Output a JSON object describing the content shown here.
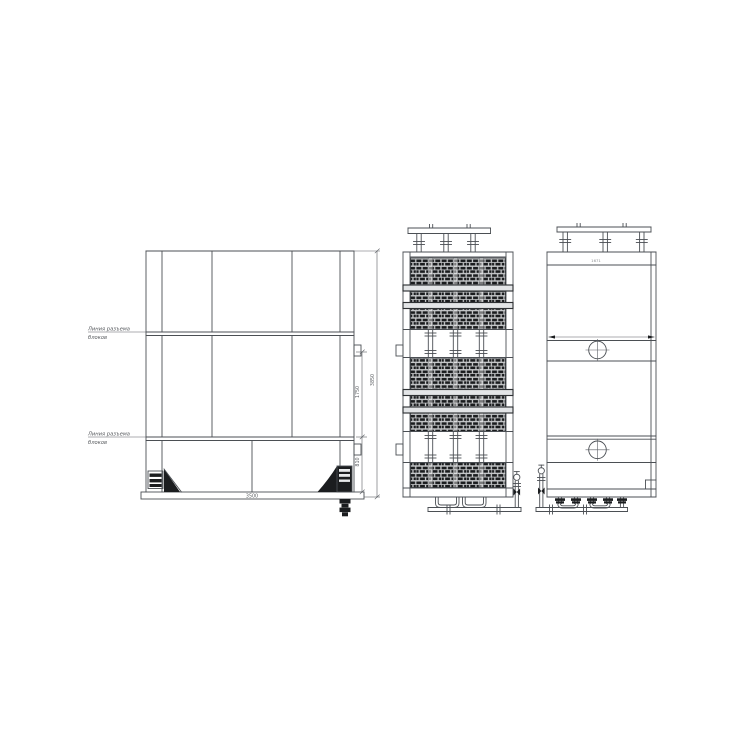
{
  "canvas": {
    "background": "#ffffff",
    "line_color": "#4b4f54",
    "dark_fill": "#1b1d1f"
  },
  "front_view": {
    "labels": {
      "upper_parting": [
        "Линия разъема",
        "блоков"
      ],
      "lower_parting": [
        "Линия разъема",
        "блоков"
      ]
    },
    "dimensions": {
      "width": "3500",
      "overall_height": "3850",
      "middle_height": "1750",
      "base_height": "810"
    }
  },
  "end_view": {
    "top_marking": "1671"
  },
  "icons": {
    "center_mark": "crosshair-circle",
    "valve": "gate-valve-with-handwheel"
  }
}
